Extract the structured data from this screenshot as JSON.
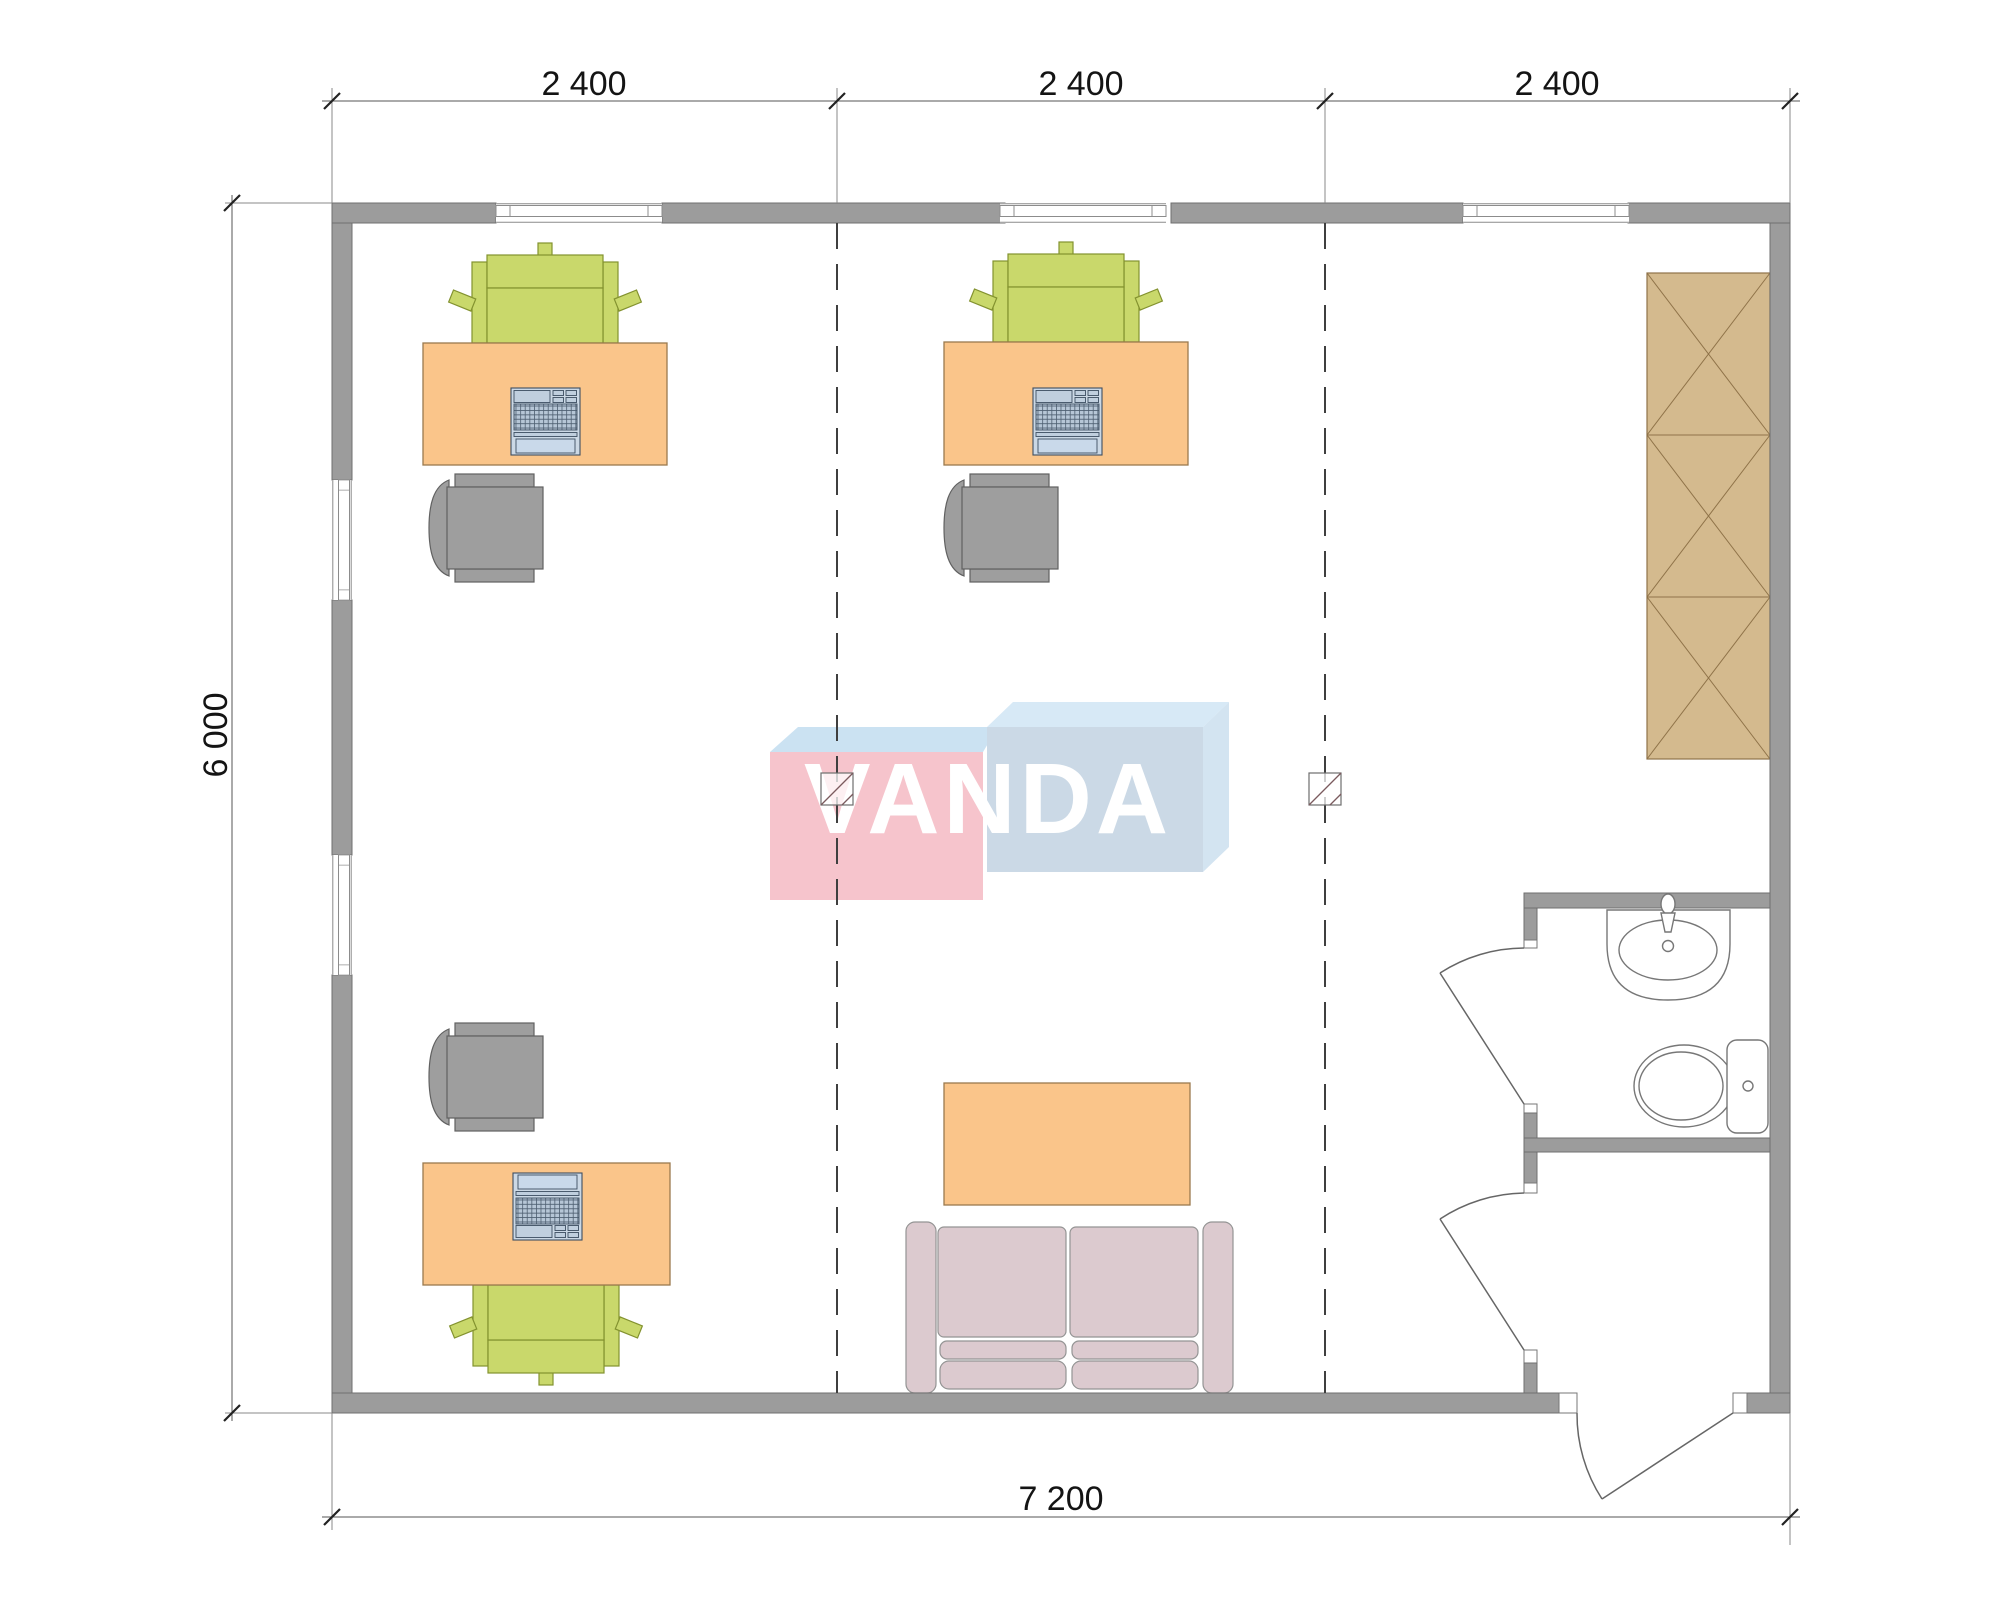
{
  "drawing": {
    "watermark": "VANDA",
    "dimensions": {
      "top": [
        "2 400",
        "2 400",
        "2 400"
      ],
      "left": "6 000",
      "bottom": "7 200"
    },
    "colors": {
      "wall_fill": "#9c9c9c",
      "wall_outline": "#6f6f6f",
      "desk": "#fac58a",
      "task_chair": "#c9d86b",
      "visitor_chair": "#9e9e9e",
      "laptop": "#cbd8e5",
      "wardrobe": "#d4ba8e",
      "sofa": "#dccacf",
      "coffee_table": "#fac58a",
      "logo_pink": "#f6c4cc",
      "logo_blue": "#cbd9e6",
      "logo_top_face": "#d7e9f6",
      "logo_text": "#ffffff",
      "dimension_text": "#141414"
    },
    "furniture_icons": [
      "desk-with-laptop",
      "task-chair",
      "visitor-chair",
      "wardrobe",
      "sofa",
      "coffee-table",
      "sink",
      "toilet",
      "window",
      "door-swing",
      "grid-line",
      "grid-marker"
    ]
  }
}
